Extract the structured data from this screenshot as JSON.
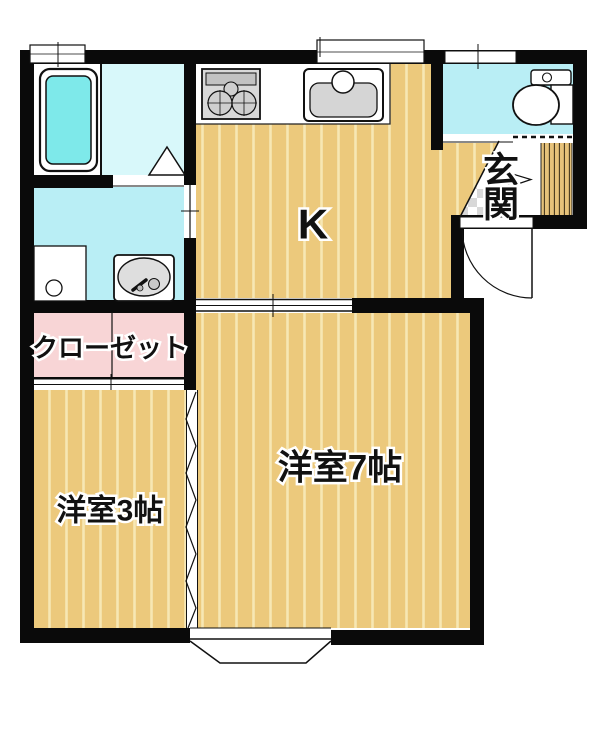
{
  "plan": {
    "kind": "floor-plan",
    "rooms": [
      {
        "id": "kitchen",
        "label": "K"
      },
      {
        "id": "entrance",
        "label": "玄関",
        "label_vertical": [
          "玄",
          "関"
        ]
      },
      {
        "id": "closet",
        "label": "クローゼット"
      },
      {
        "id": "western-room-7",
        "label": "洋室7帖"
      },
      {
        "id": "western-room-3",
        "label": "洋室3帖"
      }
    ],
    "fixtures": [
      "bathtub",
      "washing-machine-pan",
      "vanity-sink",
      "gas-stove",
      "kitchen-sink",
      "toilet",
      "entrance-door",
      "bay-window",
      "accordion-door",
      "sliding-door",
      "deck-boards",
      "entrance-tiles"
    ],
    "colors": {
      "wall": "#0a0a0a",
      "wood_floor": "#ecc97c",
      "wood_stripe": "#f7e7b4",
      "water_area": "#b9eef5",
      "bath_floor": "#d8f8fa",
      "bathtub": "#7ee9ea",
      "closet_pink": "#f8d5d6",
      "fixture_gray": "#d5d5d5",
      "deck_wood": "#e6c27a",
      "tile_gray": "#d8d8d8"
    }
  }
}
